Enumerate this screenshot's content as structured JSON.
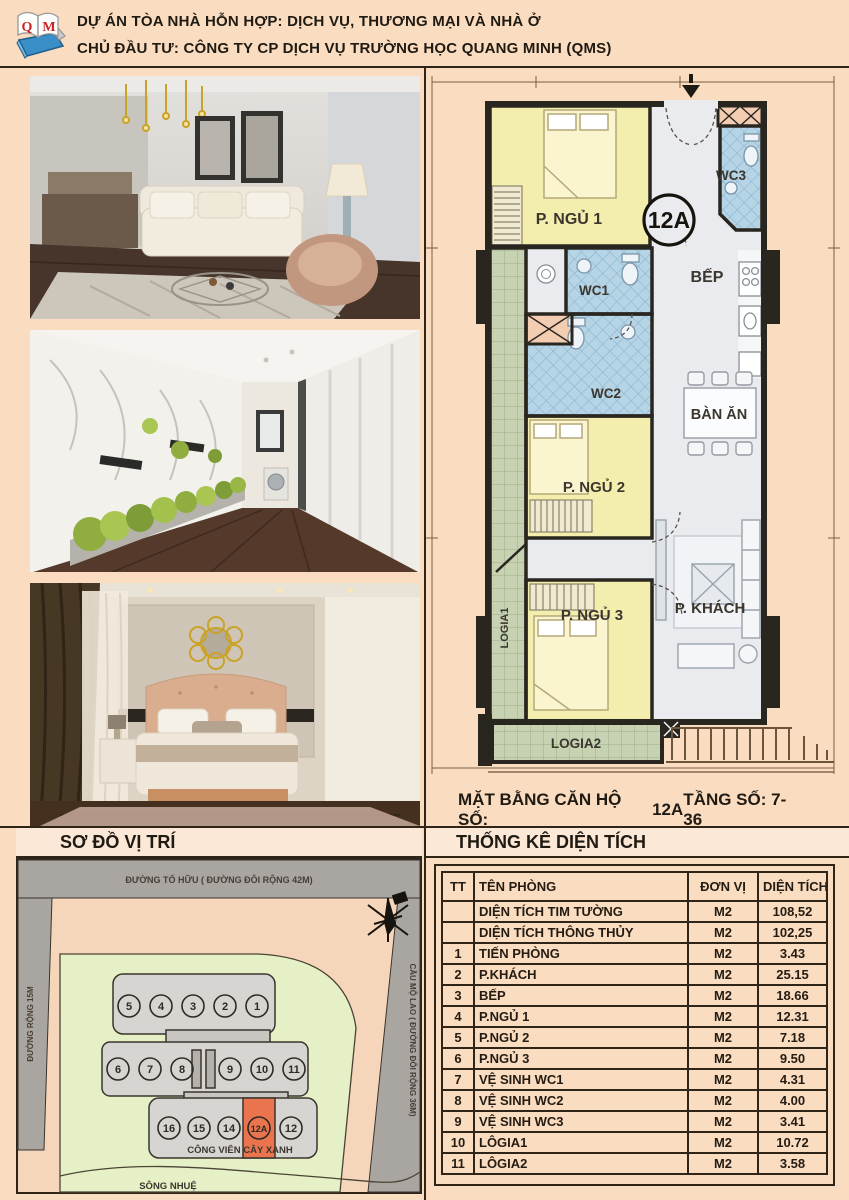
{
  "header": {
    "line1": "DỰ ÁN TÒA NHÀ HỖN HỢP: DỊCH VỤ, THƯƠNG MẠI VÀ NHÀ Ở",
    "line2": "CHỦ ĐẦU TƯ: CÔNG TY CP DỊCH VỤ TRƯỜNG HỌC QUANG MINH (QMS)",
    "logo_letter_q": "Q",
    "logo_letter_m": "M"
  },
  "floor_plan": {
    "unit_badge": "12A",
    "rooms": {
      "ngu1": "P. NGỦ 1",
      "ngu2": "P. NGỦ 2",
      "ngu3": "P. NGỦ 3",
      "khach": "P. KHÁCH",
      "bep": "BẾP",
      "ban_an": "BÀN ĂN",
      "wc1": "WC1",
      "wc2": "WC2",
      "wc3": "WC3",
      "logia1": "LOGIA1",
      "logia2": "LOGIA2"
    },
    "caption_prefix": "MẶT BẰNG CĂN HỘ SỐ:",
    "caption_unit": "12A",
    "caption_floor": "TẦNG SỐ: 7-36"
  },
  "site_map": {
    "title": "SƠ ĐỒ VỊ TRÍ",
    "road_top": "ĐƯỜNG TỐ HỮU ( ĐƯỜNG ĐÔI RỘNG 42M)",
    "road_left": "ĐƯỜNG RỘNG 15M",
    "road_right": "CẦU MỘ LAO ( ĐƯỜNG ĐÔI RỘNG 36M)",
    "park_label": "CÔNG VIÊN CÂY XANH",
    "river_label": "SÔNG NHUỆ",
    "units_row1": [
      "5",
      "4",
      "3",
      "2",
      "1"
    ],
    "units_row2": [
      "6",
      "7",
      "8",
      "9",
      "10",
      "11"
    ],
    "units_row3": [
      "16",
      "15",
      "14",
      "12A",
      "12"
    ],
    "highlighted_unit": "12A"
  },
  "area_table": {
    "title": "THỐNG KÊ DIỆN TÍCH",
    "columns": [
      "TT",
      "TÊN PHÒNG",
      "ĐƠN VỊ",
      "DIỆN TÍCH"
    ],
    "rows": [
      [
        "",
        "DIỆN TÍCH TIM TƯỜNG",
        "M2",
        "108,52"
      ],
      [
        "",
        "DIỆN TÍCH THÔNG THỦY",
        "M2",
        "102,25"
      ],
      [
        "1",
        "TIẾN PHÒNG",
        "M2",
        "3.43"
      ],
      [
        "2",
        "P.KHÁCH",
        "M2",
        "25.15"
      ],
      [
        "3",
        "BẾP",
        "M2",
        "18.66"
      ],
      [
        "4",
        "P.NGỦ 1",
        "M2",
        "12.31"
      ],
      [
        "5",
        "P.NGỦ 2",
        "M2",
        "7.18"
      ],
      [
        "6",
        "P.NGỦ 3",
        "M2",
        "9.50"
      ],
      [
        "7",
        "VỆ SINH WC1",
        "M2",
        "4.31"
      ],
      [
        "8",
        "VỆ SINH WC2",
        "M2",
        "4.00"
      ],
      [
        "9",
        "VỆ SINH WC3",
        "M2",
        "3.41"
      ],
      [
        "10",
        "LÔGIA1",
        "M2",
        "10.72"
      ],
      [
        "11",
        "LÔGIA2",
        "M2",
        "3.58"
      ]
    ]
  },
  "colors": {
    "page_bg": "#fadcc0",
    "line_dark": "#2e2418",
    "bar_bg": "#fce8d6",
    "room_yellow": "#f4eeae",
    "room_wc_blue": "#b5d4e6",
    "room_gray": "#e9ebee",
    "logia_green": "#c6d2b2",
    "wall_black": "#29251f",
    "highlight_orange": "#e9744e",
    "road_gray": "#a9a5a1",
    "park_green": "#e6f0c6"
  }
}
